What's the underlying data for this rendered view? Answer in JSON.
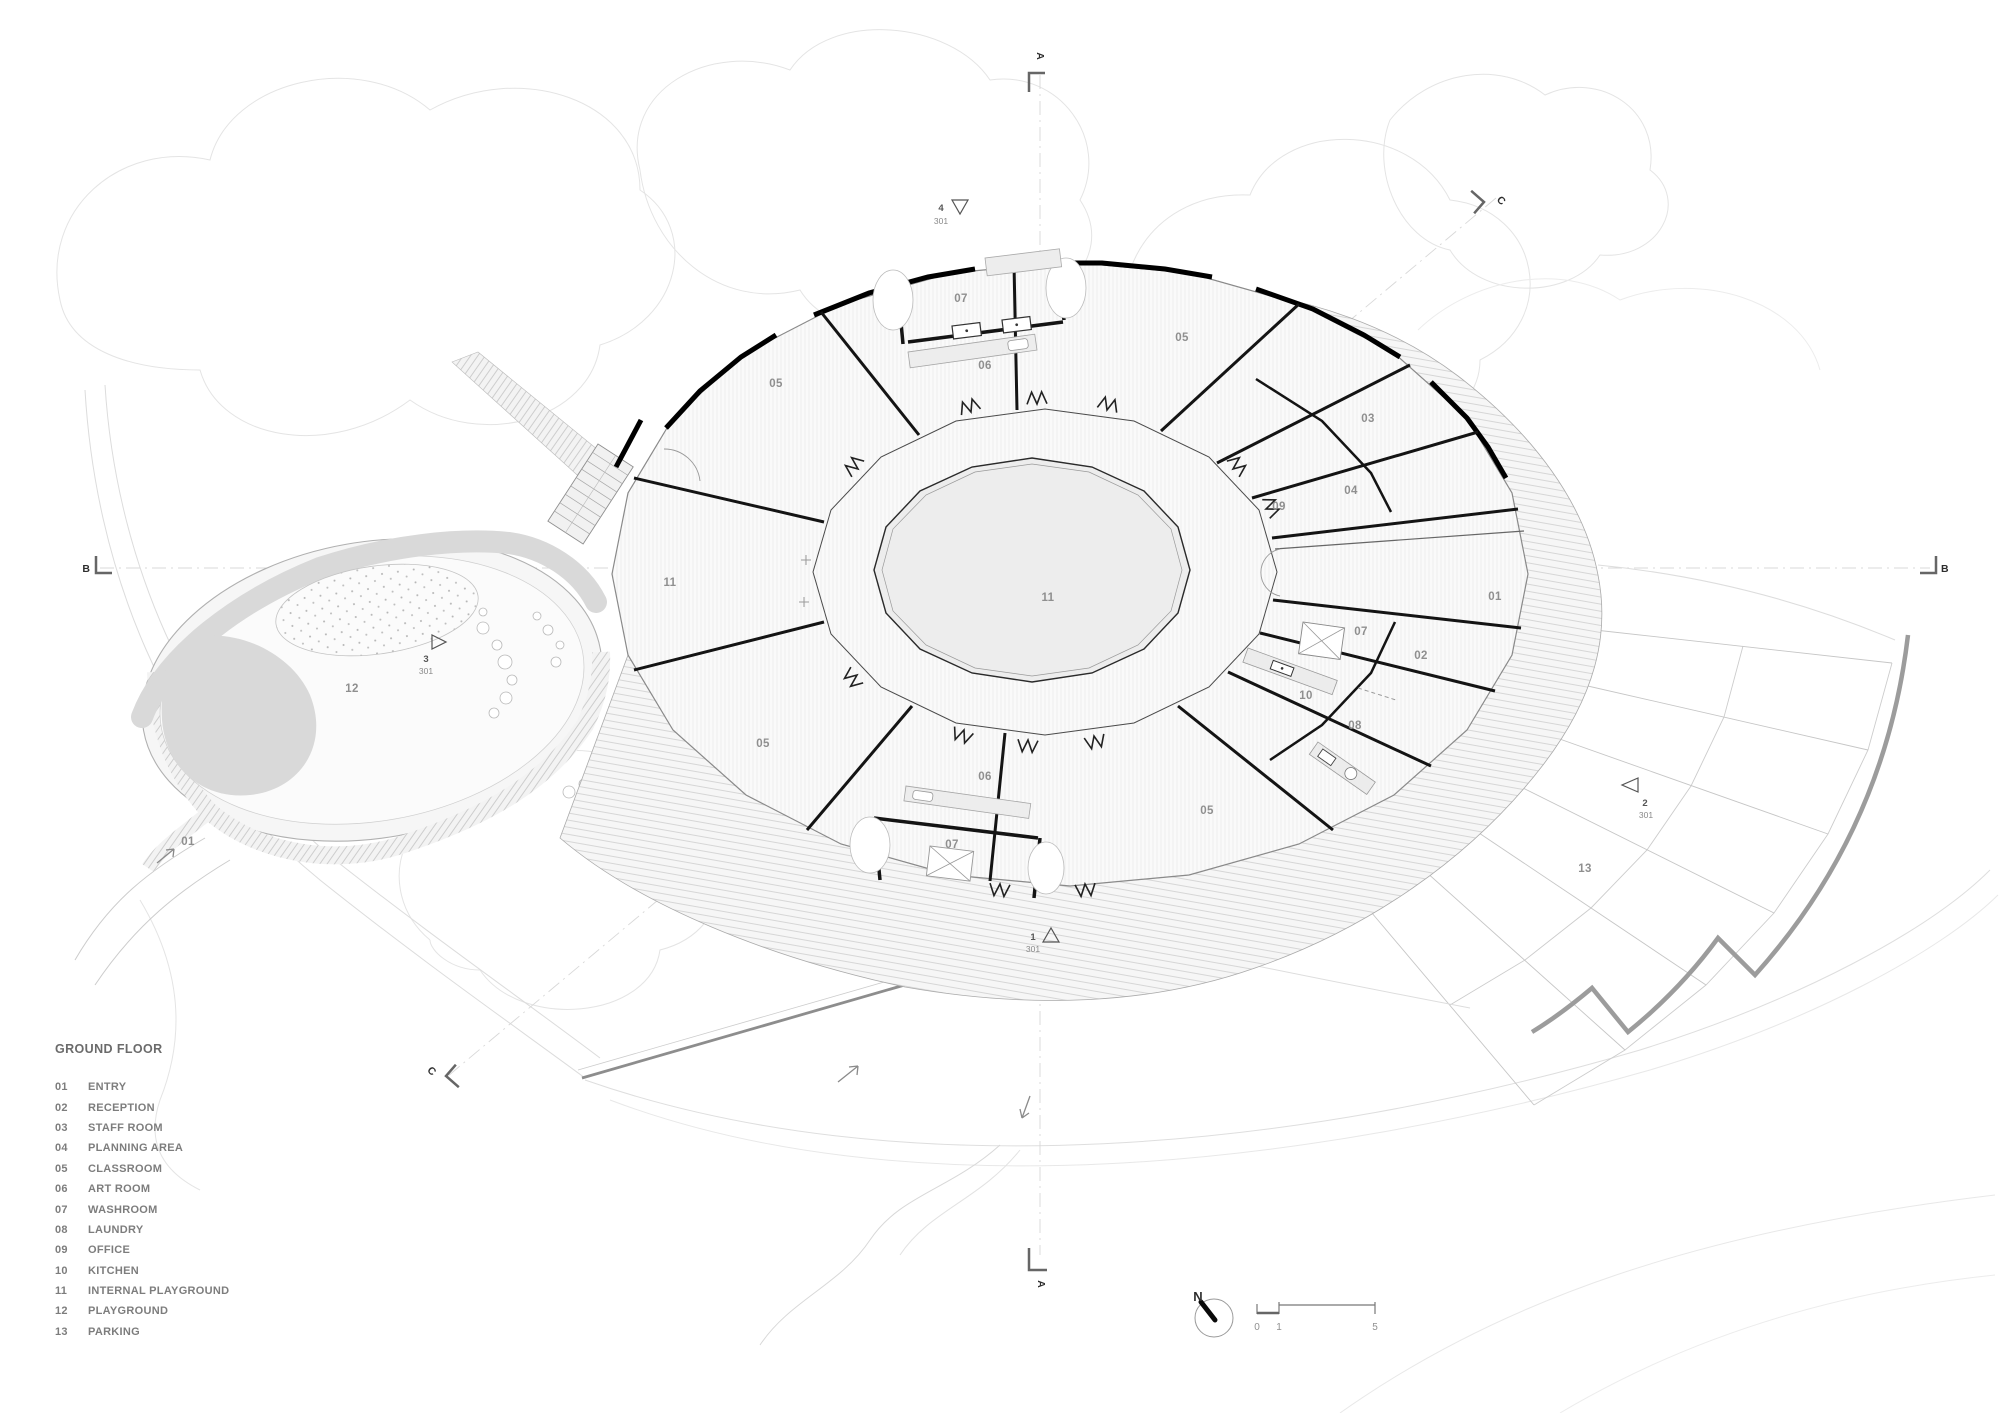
{
  "legend": {
    "title": "GROUND FLOOR",
    "items": [
      {
        "num": "01",
        "name": "ENTRY"
      },
      {
        "num": "02",
        "name": "RECEPTION"
      },
      {
        "num": "03",
        "name": "STAFF ROOM"
      },
      {
        "num": "04",
        "name": "PLANNING AREA"
      },
      {
        "num": "05",
        "name": "CLASSROOM"
      },
      {
        "num": "06",
        "name": "ART ROOM"
      },
      {
        "num": "07",
        "name": "WASHROOM"
      },
      {
        "num": "08",
        "name": "LAUNDRY"
      },
      {
        "num": "09",
        "name": "OFFICE"
      },
      {
        "num": "10",
        "name": "KITCHEN"
      },
      {
        "num": "11",
        "name": "INTERNAL PLAYGROUND"
      },
      {
        "num": "12",
        "name": "PLAYGROUND"
      },
      {
        "num": "13",
        "name": "PARKING"
      }
    ]
  },
  "rooms": {
    "classroom_top_left": "05",
    "classroom_top_right": "05",
    "classroom_bottom_left": "05",
    "classroom_bottom_right": "05",
    "washroom_top": "07",
    "washroom_bottom": "07",
    "washroom_east": "07",
    "artroom_top": "06",
    "artroom_bottom": "06",
    "staff_room": "03",
    "planning_area": "04",
    "office": "09",
    "reception": "02",
    "kitchen": "10",
    "laundry": "08",
    "entry_east": "01",
    "entry_path": "01",
    "internal_playground_center": "11",
    "internal_playground_west": "11",
    "playground": "12",
    "parking": "13"
  },
  "markers": {
    "a_top": "A",
    "a_bottom": "A",
    "b_left": "B",
    "b_right": "B",
    "c_top": "C",
    "c_bottom": "C"
  },
  "details": {
    "top": {
      "num": "4",
      "sheet": "301"
    },
    "playground": {
      "num": "3",
      "sheet": "301"
    },
    "bottom": {
      "num": "1",
      "sheet": "301"
    },
    "parking": {
      "num": "2",
      "sheet": "301"
    }
  },
  "north": {
    "label": "N"
  },
  "scale": {
    "t0": "0",
    "t1": "1",
    "t5": "5"
  },
  "colors": {
    "paper": "#ffffff",
    "wall": "#141414",
    "line_light": "#c9c9c9",
    "fill_light": "#f4f4f4",
    "fill_mid": "#d9d9d9",
    "label": "#8f8f8f",
    "parking_border": "#9c9c9c"
  }
}
